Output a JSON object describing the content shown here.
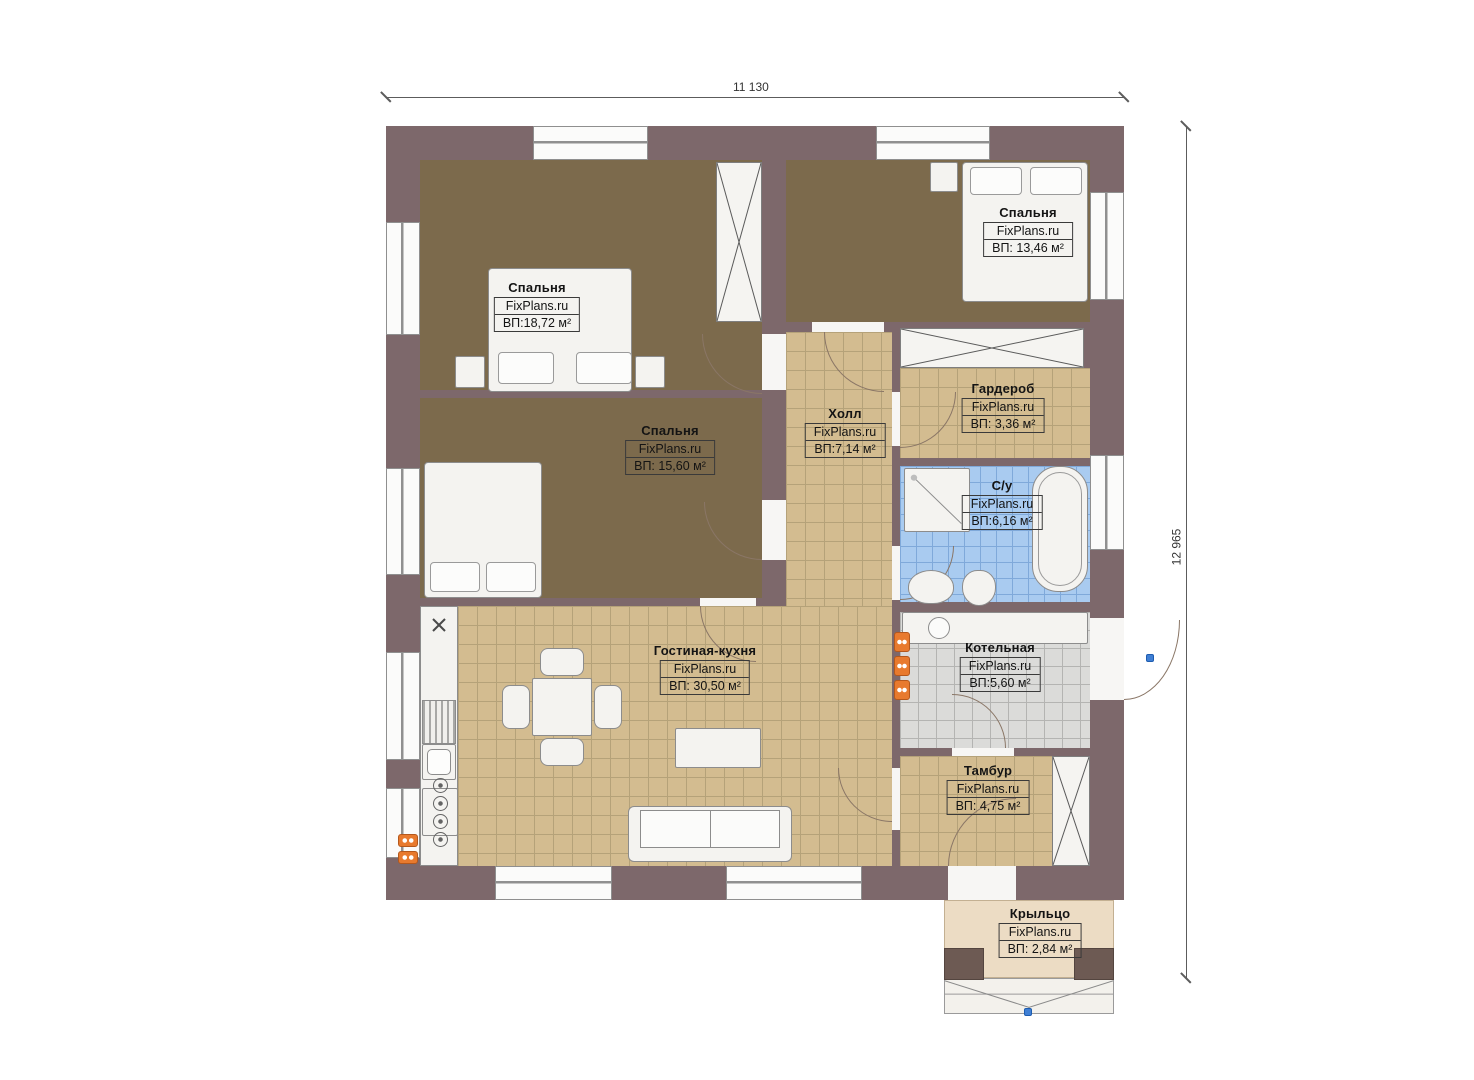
{
  "dimensions": {
    "top": "11 130",
    "right": "12 965"
  },
  "watermark": "FixPlans.ru",
  "rooms": {
    "bedroom1": {
      "name": "Спальня",
      "area": "ВП:18,72 м²"
    },
    "bedroom2": {
      "name": "Спальня",
      "area": "ВП: 13,46 м²"
    },
    "bedroom3": {
      "name": "Спальня",
      "area": "ВП: 15,60 м²"
    },
    "hall": {
      "name": "Холл",
      "area": "ВП:7,14 м²"
    },
    "wardrobe": {
      "name": "Гардероб",
      "area": "ВП: 3,36 м²"
    },
    "bathroom": {
      "name": "С/у",
      "area": "ВП:6,16 м²"
    },
    "living": {
      "name": "Гостиная-кухня",
      "area": "ВП: 30,50 м²"
    },
    "boiler": {
      "name": "Котельная",
      "area": "ВП:5,60 м²"
    },
    "tambur": {
      "name": "Тамбур",
      "area": "ВП: 4,75 м²"
    },
    "porch": {
      "name": "Крыльцо",
      "area": "ВП: 2,84 м²"
    }
  },
  "colors": {
    "wall": "#7d686b",
    "carpet": "#7c6a4c",
    "tile": "#d3bc90",
    "bath_tile": "#a9cbf0",
    "boiler_tile": "#dbdbd9",
    "porch": "#ecdcc4",
    "radiator": "#e87a2e",
    "handle": "#3f7fd4"
  }
}
